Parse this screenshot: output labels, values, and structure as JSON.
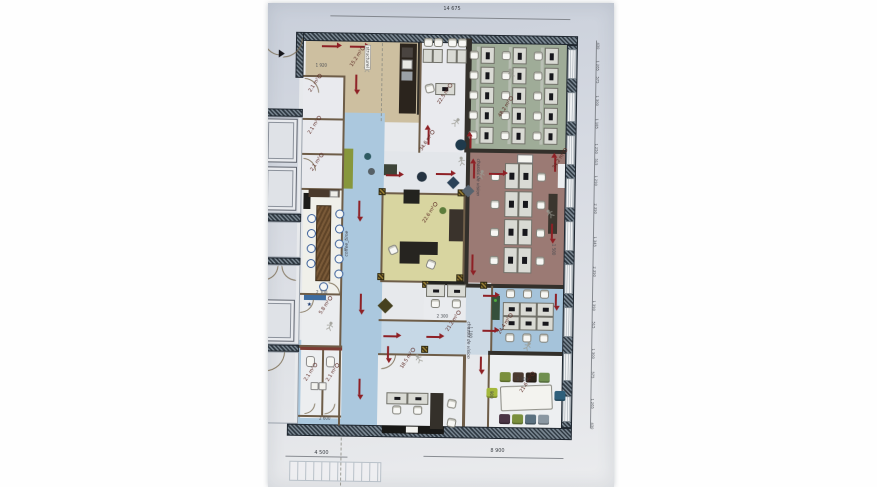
{
  "dims": {
    "total_width": "14 675",
    "bottom_left": "4 500",
    "bottom_right": "8 900"
  },
  "colors": {
    "arrow": "#8e2025",
    "paper": "#d6dae2",
    "wall": "#33302b",
    "label": "#5c2a24",
    "green_room": "#9fac98",
    "maroon_room": "#9b7a74",
    "yellow_room": "#d8d5a0",
    "blue_corridor": "#abc8de",
    "tan_room": "#cdbfa0"
  },
  "rooms": [
    [
      300,
      36,
      278,
      390,
      "#e7e9ec",
      "floor-base"
    ],
    [
      306,
      41,
      114,
      80,
      "#cdbfa0",
      "room-kitchen-open"
    ],
    [
      420,
      41,
      48,
      110,
      "#e9eaee",
      "room-office-22-5"
    ],
    [
      470,
      36,
      97,
      114,
      "#9fac98",
      "room-openspace-green"
    ],
    [
      470,
      150,
      97,
      133,
      "#9b7a74",
      "room-openspace-maroon"
    ],
    [
      345,
      112,
      41,
      313,
      "#abc8de",
      "corridor-main"
    ],
    [
      386,
      150,
      84,
      41,
      "#e3e6ea",
      "lounge-area"
    ],
    [
      306,
      190,
      39,
      105,
      "#f0f0ea",
      "room-coffee"
    ],
    [
      304,
      75,
      41,
      115,
      "#e9eaee",
      "rooms-small-left"
    ],
    [
      386,
      191,
      82,
      90,
      "#d8d5a0",
      "room-exec-office"
    ],
    [
      428,
      280,
      67,
      38,
      "#e9ebee",
      "room-21-2"
    ],
    [
      386,
      318,
      109,
      34,
      "#c6d8e6",
      "corridor-center"
    ],
    [
      470,
      283,
      25,
      69,
      "#ccd9e4",
      "corridor-right"
    ],
    [
      495,
      283,
      72,
      65,
      "#a5c3da",
      "room-office-blue"
    ],
    [
      304,
      340,
      41,
      85,
      "#abc8de",
      "corridor-wc"
    ],
    [
      306,
      295,
      39,
      50,
      "#ebedef",
      "room-5-8"
    ],
    [
      306,
      348,
      41,
      70,
      "#eceef0",
      "rooms-wc"
    ],
    [
      383,
      352,
      87,
      72,
      "#ebedef",
      "room-18-5"
    ],
    [
      493,
      352,
      74,
      72,
      "#edeff1",
      "room-meeting"
    ]
  ],
  "walls": [
    [
      300,
      32,
      278,
      9,
      "H"
    ],
    [
      293,
      424,
      285,
      12,
      "H"
    ],
    [
      296,
      32,
      8,
      46,
      "H"
    ],
    [
      262,
      109,
      42,
      8,
      "H"
    ],
    [
      262,
      214,
      42,
      8,
      "H"
    ],
    [
      262,
      258,
      42,
      7,
      "H"
    ],
    [
      262,
      345,
      42,
      7,
      "H"
    ],
    [
      567,
      41,
      11,
      383,
      "H"
    ],
    [
      466,
      36,
      6,
      114,
      "D"
    ],
    [
      468,
      150,
      4,
      133,
      "D"
    ],
    [
      470,
      146,
      97,
      4,
      "D"
    ],
    [
      470,
      281,
      97,
      4,
      "D"
    ],
    [
      493,
      348,
      74,
      4,
      "D"
    ],
    [
      418,
      41,
      3,
      72,
      "D"
    ],
    [
      304,
      75,
      41,
      2,
      "B"
    ],
    [
      304,
      118,
      41,
      2,
      "B"
    ],
    [
      304,
      153,
      41,
      2,
      "B"
    ],
    [
      304,
      188,
      41,
      2,
      "B"
    ],
    [
      304,
      293,
      41,
      2,
      "B"
    ],
    [
      304,
      345,
      43,
      3,
      "B"
    ],
    [
      327,
      350,
      2,
      66,
      "B"
    ],
    [
      304,
      415,
      43,
      2,
      "B"
    ],
    [
      344,
      75,
      2,
      115,
      "B"
    ],
    [
      344,
      190,
      2,
      105,
      "B"
    ],
    [
      344,
      295,
      2,
      130,
      "B"
    ],
    [
      384,
      191,
      2,
      90,
      "B"
    ],
    [
      466,
      191,
      2,
      90,
      "B"
    ],
    [
      386,
      191,
      80,
      2,
      "B"
    ],
    [
      386,
      279,
      80,
      2,
      "B"
    ],
    [
      383,
      318,
      88,
      2,
      "B"
    ],
    [
      383,
      352,
      87,
      2,
      "B"
    ],
    [
      493,
      352,
      2,
      72,
      "B"
    ],
    [
      468,
      352,
      3,
      72,
      "B"
    ],
    [
      420,
      41,
      2,
      110,
      "B"
    ],
    [
      495,
      283,
      2,
      65,
      "B"
    ],
    [
      262,
      36,
      1,
      390,
      "L"
    ]
  ],
  "windows": [
    [
      45,
      30
    ],
    [
      88,
      30
    ],
    [
      131,
      30
    ],
    [
      174,
      30
    ],
    [
      217,
      30
    ],
    [
      260,
      30
    ],
    [
      303,
      30
    ],
    [
      349,
      28
    ],
    [
      392,
      26
    ]
  ],
  "columns": [
    [
      381,
      187
    ],
    [
      460,
      187
    ],
    [
      381,
      272
    ],
    [
      460,
      272
    ],
    [
      426,
      279
    ],
    [
      484,
      279
    ],
    [
      470,
      110
    ],
    [
      426,
      344
    ]
  ],
  "rects": [
    [
      400,
      42,
      17,
      70,
      "#2b241d",
      null,
      0,
      0,
      "kitchen-counter"
    ],
    [
      402,
      46,
      11,
      10,
      "#4a4440",
      null,
      0,
      0,
      "appliance"
    ],
    [
      402,
      58,
      11,
      10,
      "#e8e8e4",
      "#777777",
      0,
      0,
      "kitchen-sink"
    ],
    [
      402,
      70,
      11,
      9,
      "#9aa0a6",
      null,
      0,
      0,
      "appliance"
    ],
    [
      432,
      279,
      36,
      4,
      "#23231f",
      null,
      0,
      0,
      "wall-cabinet"
    ],
    [
      388,
      424,
      62,
      8,
      "#181816",
      null,
      0,
      0,
      "media-credenza"
    ],
    [
      412,
      425,
      12,
      6,
      "#f2f2ee",
      null,
      0,
      0,
      "white-box"
    ],
    [
      346,
      148,
      9,
      40,
      "#87973c",
      null,
      0,
      0,
      "bench"
    ],
    [
      386,
      163,
      13,
      11,
      "#3d4438",
      null,
      0,
      0,
      "storage-chest"
    ],
    [
      306,
      193,
      7,
      16,
      "#1d1d1b",
      null,
      0,
      0,
      "counter"
    ],
    [
      311,
      189,
      31,
      8,
      "#4a3a2c",
      null,
      0,
      0,
      "coffee-cabinet"
    ],
    [
      332,
      190,
      9,
      7,
      "#eeeee9",
      "#888888",
      0,
      0,
      "coffee-machine"
    ],
    [
      319,
      205,
      15,
      76,
      "wood",
      null,
      0,
      0,
      "coffee-table"
    ],
    [
      406,
      188,
      16,
      14,
      "#23231f",
      null,
      0,
      0,
      "storage-box"
    ],
    [
      452,
      207,
      14,
      32,
      "#3a332c",
      null,
      0,
      0,
      "credenza"
    ],
    [
      403,
      240,
      38,
      13,
      "#262420",
      null,
      0,
      0,
      "executive-desk"
    ],
    [
      403,
      253,
      20,
      9,
      "#262420",
      null,
      0,
      0,
      "executive-desk-return"
    ],
    [
      506,
      382,
      52,
      25,
      "#f3f3ef",
      "#8a8a82",
      2,
      -3,
      "meeting-table"
    ],
    [
      519,
      151,
      16,
      9,
      "#f4f4f0",
      "#777777",
      0,
      0,
      "printer-table"
    ],
    [
      551,
      190,
      9,
      40,
      "#3b362f",
      null,
      0,
      0,
      "tall-cabinet"
    ],
    [
      308,
      295,
      22,
      5,
      "#3e6da1",
      null,
      0,
      0,
      "window-blue"
    ],
    [
      496,
      293,
      8,
      24,
      "#36503b",
      null,
      0,
      0,
      "green-cabinet"
    ],
    [
      311,
      356,
      9,
      11,
      "#f6f6f2",
      "#888888",
      3,
      0,
      "toilet"
    ],
    [
      331,
      356,
      9,
      11,
      "#f6f6f2",
      "#888888",
      3,
      0,
      "toilet"
    ],
    [
      316,
      382,
      8,
      8,
      "#f2f2ee",
      "#888888",
      1,
      0,
      "washbasin"
    ],
    [
      324,
      382,
      8,
      8,
      "#f2f2ee",
      "#888888",
      1,
      0,
      "washbasin"
    ],
    [
      305,
      347,
      42,
      3,
      "#7c3c34",
      null,
      0,
      0,
      "wall-accent"
    ],
    [
      255,
      128,
      7,
      30,
      null,
      "#a8aeb6",
      0,
      0,
      "radiator"
    ],
    [
      255,
      303,
      7,
      30,
      null,
      "#a8aeb6",
      0,
      0,
      "radiator"
    ],
    [
      262,
      117,
      42,
      97,
      null,
      "#9aa2ac",
      0,
      0,
      "annex-room"
    ],
    [
      262,
      222,
      42,
      36,
      null,
      "#9aa2ac",
      0,
      0,
      "annex-room"
    ],
    [
      262,
      265,
      42,
      80,
      null,
      "#9aa2ac",
      0,
      0,
      "annex-room"
    ],
    [
      262,
      352,
      42,
      72,
      null,
      "#9aa2ac",
      0,
      0,
      "annex-room"
    ],
    [
      477,
      44,
      3,
      97,
      "#b9bfb4",
      null,
      0,
      0,
      "locker-strip"
    ],
    [
      509,
      44,
      3,
      97,
      "#b9bfb4",
      null,
      0,
      0,
      "locker-strip"
    ],
    [
      541,
      44,
      3,
      97,
      "#b9bfb4",
      null,
      0,
      0,
      "locker-strip"
    ],
    [
      296,
      461,
      92,
      20,
      "stairs",
      null,
      0,
      0,
      "stairs-sketch"
    ],
    [
      436,
      391,
      13,
      36,
      "#34302a",
      null,
      0,
      0,
      "cabinet"
    ],
    [
      560,
      160,
      7,
      24,
      "#eceef0",
      null,
      0,
      0,
      "window-sill"
    ]
  ],
  "circles": [
    [
      457,
      137,
      11,
      "#1f3a4c",
      "round-table"
    ],
    [
      419,
      170,
      10,
      "#243341",
      "pouf-round"
    ],
    [
      366,
      152,
      7,
      "#2e5a62",
      "stool"
    ],
    [
      370,
      167,
      7,
      "#566066",
      "stool"
    ],
    [
      442,
      205,
      7,
      "#5d7d3c",
      "plant"
    ],
    [
      498,
      296,
      3,
      "#4fae3e",
      "indicator-light"
    ]
  ],
  "desk_groups": [
    [
      481,
      44,
      32,
      20,
      3,
      5,
      14,
      17,
      4,
      7
    ],
    [
      507,
      160,
      14,
      28,
      2,
      4,
      14,
      26,
      5,
      7
    ],
    [
      507,
      299,
      17,
      14,
      3,
      2,
      17,
      14,
      6,
      4
    ],
    [
      423,
      47,
      10,
      0,
      2,
      1,
      10,
      14,
      0,
      0
    ],
    [
      447,
      47,
      10,
      0,
      2,
      1,
      10,
      14,
      0,
      0
    ],
    [
      436,
      81,
      0,
      0,
      1,
      1,
      20,
      12,
      6,
      4
    ],
    [
      430,
      282,
      21,
      0,
      2,
      1,
      19,
      13,
      6,
      3
    ],
    [
      392,
      391,
      21,
      0,
      2,
      1,
      21,
      12,
      6,
      3
    ]
  ],
  "chair_groups": [
    [
      470,
      48,
      32,
      20,
      3,
      5,
      0
    ],
    [
      493,
      169,
      0,
      28,
      1,
      4,
      0
    ],
    [
      539,
      169,
      0,
      28,
      1,
      4,
      0
    ],
    [
      510,
      286,
      17,
      0,
      3,
      1,
      0
    ],
    [
      510,
      330,
      17,
      0,
      3,
      1,
      0
    ],
    [
      424,
      36,
      10,
      0,
      2,
      1,
      0
    ],
    [
      448,
      36,
      10,
      0,
      2,
      1,
      0
    ],
    [
      426,
      82,
      0,
      0,
      1,
      1,
      -15
    ],
    [
      435,
      297,
      21,
      0,
      2,
      1,
      0
    ],
    [
      398,
      404,
      21,
      0,
      2,
      1,
      0
    ],
    [
      453,
      397,
      0,
      19,
      1,
      2,
      10
    ],
    [
      392,
      244,
      0,
      0,
      1,
      1,
      -25
    ],
    [
      430,
      258,
      0,
      0,
      1,
      1,
      20
    ]
  ],
  "round_chair_groups": [
    [
      310,
      214,
      0,
      15,
      1,
      4
    ],
    [
      338,
      209,
      0,
      15,
      1,
      5
    ],
    [
      323,
      282,
      0,
      0,
      1,
      1
    ]
  ],
  "meeting_chairs": [
    [
      505,
      369,
      "#7a8f3d"
    ],
    [
      518,
      369,
      "#4a3a30"
    ],
    [
      531,
      369,
      "#2e241c"
    ],
    [
      544,
      369,
      "#6f8f4f"
    ],
    [
      492,
      385,
      "#a4b83c"
    ],
    [
      560,
      387,
      "#2e5f7a"
    ],
    [
      505,
      411,
      "#4a3545"
    ],
    [
      518,
      411,
      "#7a8f3d"
    ],
    [
      531,
      411,
      "#5a7080"
    ],
    [
      544,
      411,
      "#8a97a2"
    ]
  ],
  "poufs": [
    [
      451,
      176,
      9,
      "#2b4258"
    ],
    [
      466,
      184,
      9,
      "#57636e"
    ],
    [
      384,
      299,
      11,
      "#46411f"
    ]
  ],
  "arrows": [
    [
      322,
      46,
      "right",
      15
    ],
    [
      350,
      46,
      "right",
      15
    ],
    [
      357,
      74,
      "down",
      15
    ],
    [
      362,
      200,
      "down",
      16
    ],
    [
      365,
      293,
      "down",
      16
    ],
    [
      365,
      378,
      "down",
      16
    ],
    [
      438,
      172,
      "right",
      15
    ],
    [
      388,
      174,
      "right",
      13
    ],
    [
      430,
      143,
      "up",
      15
    ],
    [
      472,
      146,
      "up",
      12
    ],
    [
      476,
      176,
      "up",
      15
    ],
    [
      491,
      171,
      "right",
      14
    ],
    [
      476,
      252,
      "down",
      16
    ],
    [
      557,
      168,
      "up",
      14
    ],
    [
      555,
      220,
      "down",
      15
    ],
    [
      487,
      293,
      "right",
      12
    ],
    [
      487,
      328,
      "right",
      12
    ],
    [
      388,
      335,
      "right",
      13
    ],
    [
      431,
      335,
      "right",
      13
    ],
    [
      393,
      345,
      "down",
      12
    ],
    [
      486,
      354,
      "down",
      13
    ],
    [
      560,
      290,
      "down",
      12
    ]
  ],
  "doors": [
    [
      283,
      38,
      20,
      "br"
    ],
    [
      263,
      38,
      18,
      "bl"
    ],
    [
      305,
      78,
      15,
      "tr"
    ],
    [
      305,
      158,
      13,
      "tr"
    ],
    [
      332,
      282,
      12,
      "tr"
    ],
    [
      304,
      299,
      14,
      "br"
    ],
    [
      310,
      403,
      11,
      "br"
    ],
    [
      330,
      403,
      11,
      "br"
    ],
    [
      386,
      353,
      15,
      "br"
    ],
    [
      267,
      266,
      15,
      "br"
    ],
    [
      285,
      266,
      15,
      "bl"
    ],
    [
      270,
      352,
      20,
      "br"
    ]
  ],
  "figures": [
    [
      362,
      57,
      0
    ],
    [
      452,
      110,
      40
    ],
    [
      506,
      60,
      -20
    ],
    [
      478,
      162,
      15
    ],
    [
      547,
      200,
      -40
    ],
    [
      329,
      316,
      20
    ],
    [
      458,
      149,
      -10
    ],
    [
      527,
      333,
      30
    ],
    [
      418,
      347,
      -30
    ]
  ],
  "area_labels": [
    [
      "15.2 m²",
      349,
      64
    ],
    [
      "22.5 m²",
      437,
      100
    ],
    [
      "48.2 m²",
      498,
      112
    ],
    [
      "34.6 m²",
      420,
      147
    ],
    [
      "34.2 m²",
      553,
      163
    ],
    [
      "22.6 m²",
      424,
      219
    ],
    [
      "2.1 m²",
      308,
      90
    ],
    [
      "2.1 m²",
      308,
      132
    ],
    [
      "2.1 m²",
      311,
      169
    ],
    [
      "5.8 m²",
      322,
      312
    ],
    [
      "2.1 m²",
      308,
      379
    ],
    [
      "2.1 m²",
      330,
      379
    ],
    [
      "21.2 m²",
      449,
      327
    ],
    [
      "18.5 m²",
      404,
      365
    ],
    [
      "24.4 m²",
      501,
      329
    ],
    [
      "21.6 m²",
      524,
      387
    ]
  ],
  "room_names": [
    [
      "structurel",
      371,
      44,
      90,
      1
    ],
    [
      "coffee_time",
      347,
      256,
      -90,
      0
    ],
    [
      "chassis de vision",
      483,
      156,
      90,
      0
    ],
    [
      "chassis de vision",
      476,
      319,
      90,
      0
    ]
  ],
  "glyphs": [
    [
      "★",
      311,
      301,
      "#1d3a6e"
    ]
  ],
  "small_dims": [
    [
      "1 920",
      316,
      63,
      0
    ],
    [
      "2 300",
      320,
      290,
      0
    ],
    [
      "2 600",
      325,
      416,
      0
    ],
    [
      "2 300",
      441,
      312,
      0
    ],
    [
      "2 300",
      522,
      374,
      0
    ],
    [
      "900",
      499,
      388,
      90
    ],
    [
      "1 100",
      477,
      324,
      90
    ],
    [
      "1 500",
      559,
      240,
      90
    ]
  ],
  "right_chain": {
    "x": 600,
    "labels": [
      [
        "430",
        38
      ],
      [
        "1 265",
        56
      ],
      [
        "575",
        72
      ],
      [
        "1 300",
        91
      ],
      [
        "1 185",
        114
      ],
      [
        "1 250",
        139
      ],
      [
        "515",
        154
      ],
      [
        "1 290",
        171
      ],
      [
        "2 390",
        199
      ],
      [
        "1 345",
        232
      ],
      [
        "2 390",
        262
      ],
      [
        "1 390",
        296
      ],
      [
        "515",
        317
      ],
      [
        "1 300",
        344
      ],
      [
        "575",
        367
      ],
      [
        "1 265",
        394
      ],
      [
        "430",
        418
      ]
    ]
  },
  "dim_lines": [
    [
      330,
      15,
      240,
      "h"
    ],
    [
      292,
      456,
      62,
      "h"
    ],
    [
      430,
      454,
      140,
      "h"
    ],
    [
      596,
      36,
      388,
      "v"
    ]
  ],
  "dashes": [
    [
      382,
      42,
      78
    ],
    [
      347,
      437,
      48
    ]
  ],
  "elevators": [
    [
      266,
      119,
      33,
      44
    ],
    [
      266,
      167,
      33,
      44
    ],
    [
      266,
      300,
      33,
      42
    ]
  ],
  "triangles": [
    [
      279,
      50
    ]
  ]
}
